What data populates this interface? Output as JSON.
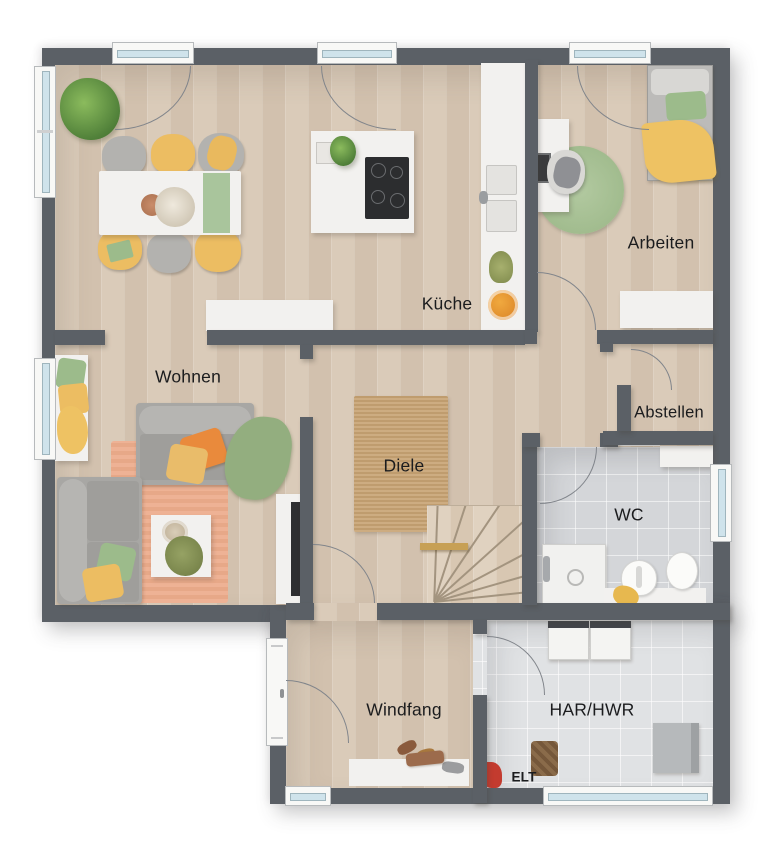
{
  "plan": {
    "type": "floorplan-top-view",
    "rooms": {
      "wohnen": {
        "label": "Wohnen"
      },
      "kueche": {
        "label": "Küche"
      },
      "arbeiten": {
        "label": "Arbeiten"
      },
      "abstellen": {
        "label": "Abstellen"
      },
      "diele": {
        "label": "Diele"
      },
      "wc": {
        "label": "WC"
      },
      "windfang": {
        "label": "Windfang"
      },
      "har_hwr": {
        "label": "HAR/HWR"
      },
      "elt": {
        "label": "ELT"
      }
    },
    "colors": {
      "wall": "#5b6066",
      "wood_floor": "#d9c9b7",
      "tile_wc": "#d4d6d9",
      "tile_har": "#e0e2e4",
      "rug_jute": "#c8a77b",
      "rug_peach": "#eeb295",
      "accent_yellow": "#ecbd62",
      "accent_orange": "#e98a3c",
      "accent_green": "#9cbb8b",
      "window_glass": "#cfe3eb"
    }
  }
}
